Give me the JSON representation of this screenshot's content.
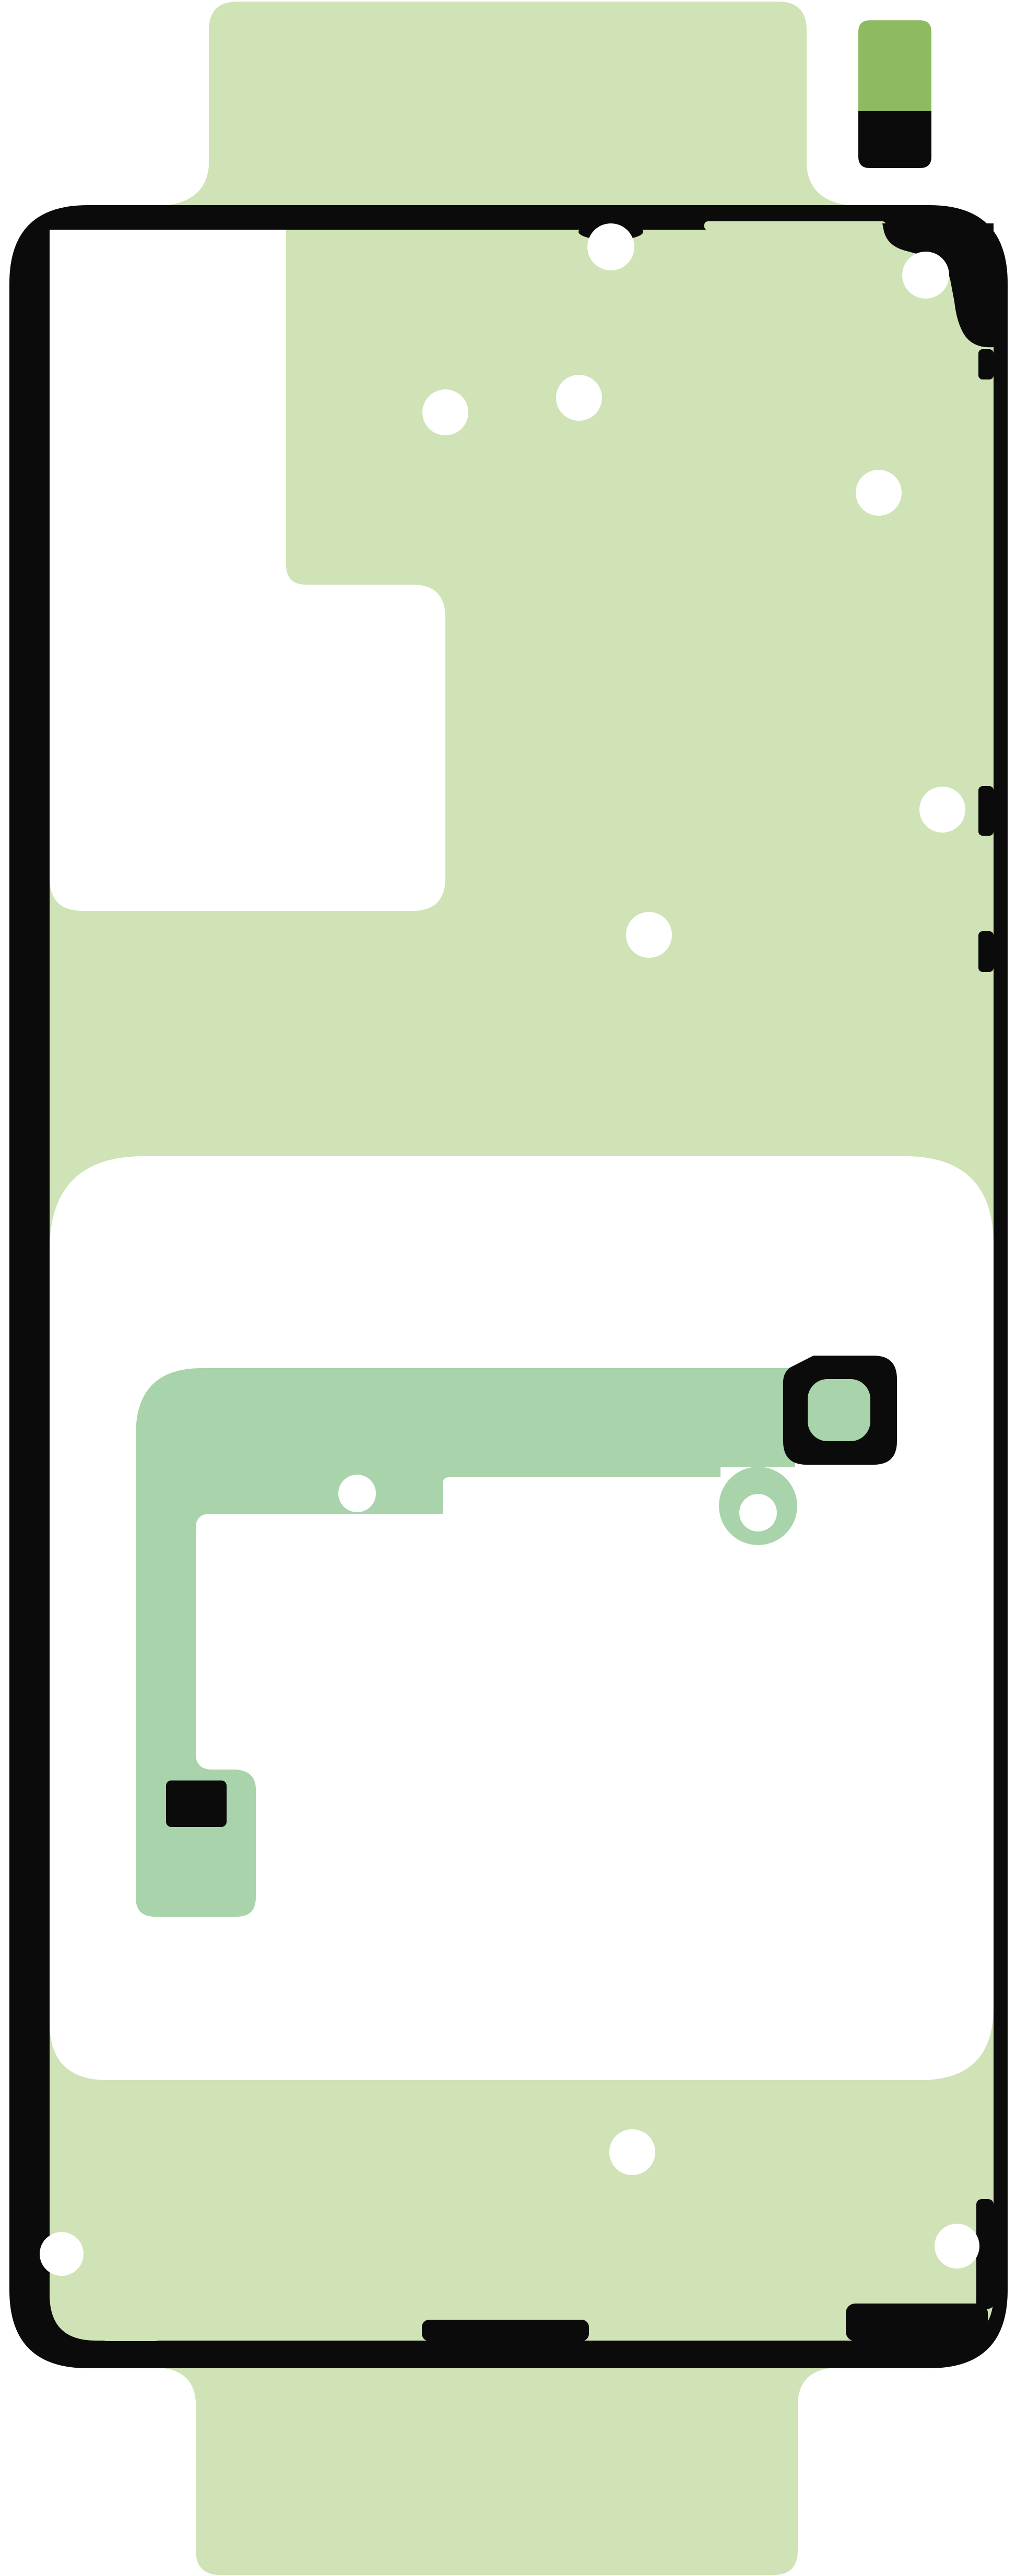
{
  "product": {
    "kind": "rear-cover-adhesive-sheet",
    "orientation": "portrait"
  },
  "colors": {
    "background": "#ffffff",
    "body_green": "#cfe3b6",
    "strip_green": "#a9d3ab",
    "pill_green": "#8eba62",
    "outline_black": "#0b0b0b",
    "cutout_white": "#ffffff"
  }
}
